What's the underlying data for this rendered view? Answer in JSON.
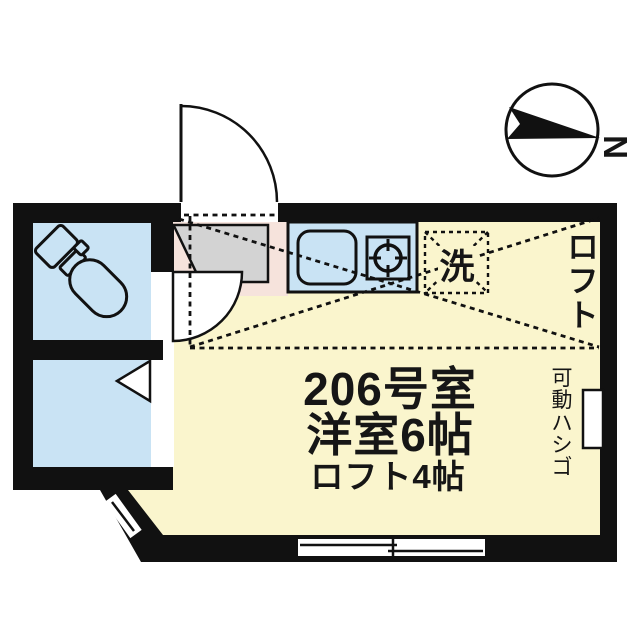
{
  "meta": {
    "kind": "apartment-floor-plan"
  },
  "compass": {
    "north_label": "N"
  },
  "main_room": {
    "room_number": "206号室",
    "room_type": "洋室6帖",
    "loft_size": "ロフト4帖"
  },
  "labels": {
    "loft_vertical": [
      "ロ",
      "フ",
      "ト"
    ],
    "ladder_vertical": [
      "可",
      "動",
      "ハ",
      "シ",
      "ゴ"
    ],
    "washer": "洗"
  },
  "colors": {
    "bg": "#ffffff",
    "wall": "#111111",
    "line": "#111111",
    "room-yellow": "#faf5cd",
    "room-blue": "#c9e3f4",
    "genkan-gray": "#d3d3d3",
    "floor-pink": "#f6e3dc"
  }
}
